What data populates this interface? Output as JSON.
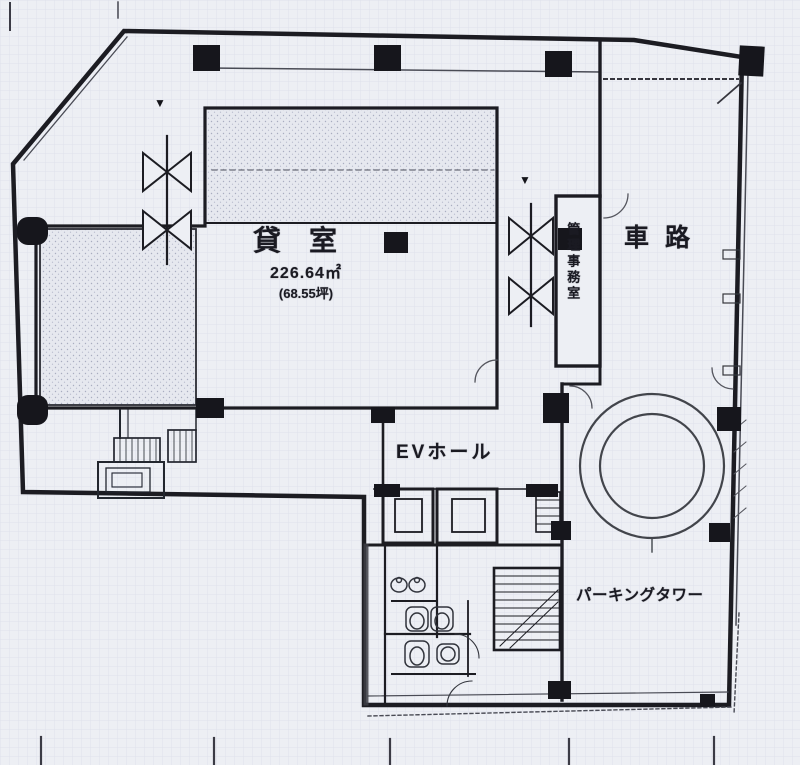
{
  "rooms": {
    "rental": {
      "label": "貸室",
      "area_m2": "226.64㎡",
      "area_tsubo": "(68.55坪)"
    },
    "ev_hall": {
      "label": "EVホール"
    },
    "driveway": {
      "label": "車路"
    },
    "office": {
      "label": "管理事務室"
    },
    "parking_tower": {
      "label": "パーキングタワー"
    }
  },
  "icons": {
    "entry_marker": "▼"
  },
  "colors": {
    "paper": "#edeff4",
    "ink": "#1b1c23",
    "grid": "#d8dbe6"
  }
}
